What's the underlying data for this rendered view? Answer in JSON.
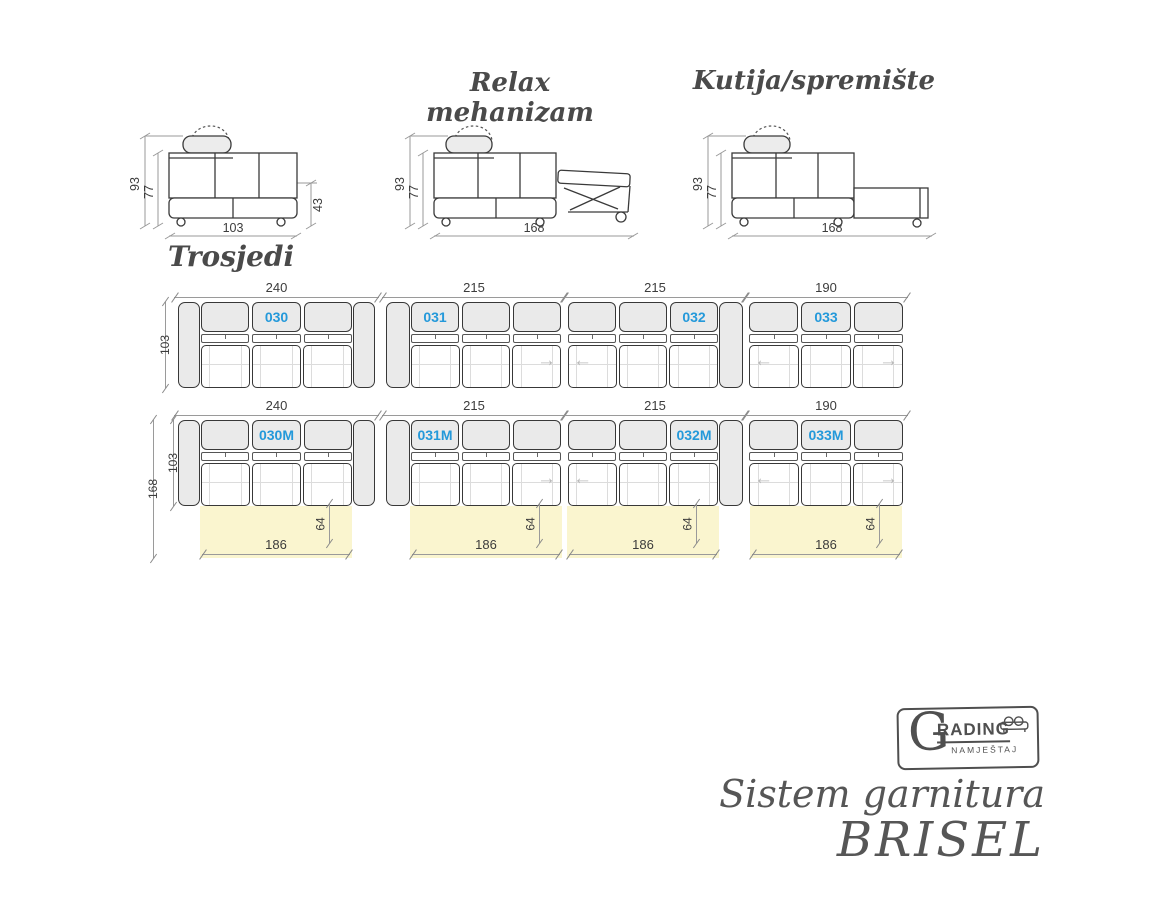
{
  "colors": {
    "accent_blue": "#2499da",
    "bed_yellow": "#faf5cf",
    "fill_gray": "#eaeaea",
    "outline": "#383838",
    "dim_gray": "#9a9a9a",
    "title_gray": "#4a4a4a",
    "footer_gray": "#565656"
  },
  "icons": {
    "arrow_left": "←",
    "arrow_right": "→"
  },
  "side_views": {
    "basic": {
      "dim_height": "93",
      "dim_inner_height": "77",
      "dim_seat_height": "43",
      "dim_width": "103"
    },
    "relax": {
      "title": "Relax mehanizam",
      "dim_height": "93",
      "dim_inner_height": "77",
      "dim_width": "168"
    },
    "storage": {
      "title": "Kutija/spremište",
      "dim_height": "93",
      "dim_inner_height": "77",
      "dim_width": "168"
    }
  },
  "trosjedi": {
    "section_title": "Trosjedi",
    "row1": [
      {
        "code": "030",
        "width": "240",
        "depth": "103"
      },
      {
        "code": "031",
        "width": "215"
      },
      {
        "code": "032",
        "width": "215"
      },
      {
        "code": "033",
        "width": "190"
      }
    ],
    "row2": [
      {
        "code": "030M",
        "width": "240",
        "depth": "103",
        "total_depth": "168",
        "bed_width": "186",
        "bed_depth": "64"
      },
      {
        "code": "031M",
        "width": "215",
        "bed_width": "186",
        "bed_depth": "64"
      },
      {
        "code": "032M",
        "width": "215",
        "bed_width": "186",
        "bed_depth": "64"
      },
      {
        "code": "033M",
        "width": "190",
        "bed_width": "186",
        "bed_depth": "64"
      }
    ]
  },
  "logo": {
    "initial": "G",
    "name_rest": "RADING",
    "subtitle": "NAMJEŠTAJ"
  },
  "footer": {
    "title_line1": "Sistem garnitura",
    "title_line2": "BRISEL"
  }
}
